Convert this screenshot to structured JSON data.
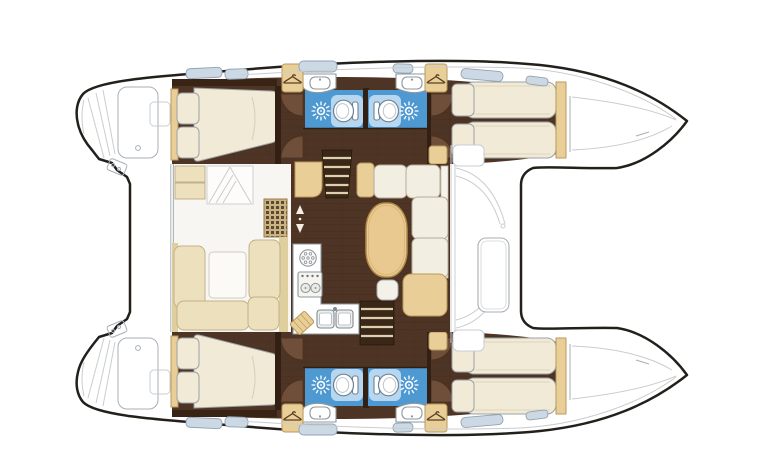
{
  "image": {
    "description": "Catamaran yacht interior layout floor plan, top-down view, bows pointing right",
    "visible_text": []
  },
  "vessel": {
    "type": "catamaran-floor-plan",
    "hulls": [
      {
        "name": "port-hull",
        "rooms": [
          "aft-double-cabin",
          "aft-head-with-shower",
          "forward-head-with-shower",
          "forward-double-cabin"
        ]
      },
      {
        "name": "starboard-hull",
        "rooms": [
          "aft-double-cabin",
          "aft-head-with-shower",
          "forward-head-with-shower",
          "forward-double-cabin"
        ]
      }
    ],
    "saloon": [
      "u-shaped-settee",
      "storage-lockers",
      "chart-grid-mat",
      "companionway-arrows",
      "galley-round-burner",
      "two-burner-stove",
      "double-sink",
      "cutting-board",
      "port-companionway-stairs",
      "starboard-companionway-stairs",
      "l-shaped-sofa",
      "oval-dining-table",
      "stool"
    ],
    "cockpit": [
      "transom-steps",
      "bench-port",
      "bench-starboard"
    ],
    "foredeck": [
      "deck-hatch",
      "step-seats"
    ],
    "fixture_counts": {
      "shower-sunburst": 4,
      "toilet": 4,
      "washbasin": 4,
      "wardrobe-hanger": 4,
      "deck-window": 12,
      "double-berth": 2,
      "twin-berth-pairs": 2
    }
  },
  "icons": {
    "sunburst-icon": "shower jet / drain",
    "toilet-icon": "marine WC",
    "hanger-icon": "hanging wardrobe",
    "basin-icon": "washbasin",
    "stove-icon": "two-burner hob",
    "sink-icon": "double galley sink",
    "arrow-icon": "up/down companionway marker"
  },
  "palette": {
    "hull-outline": "#23201c",
    "gray-line": "#a9afb5",
    "soft-line": "#c9cdd0",
    "walnut": "#4e3424",
    "walnut-deep": "#382315",
    "wall": "#332014",
    "door": "#6f4e3a",
    "door-edge": "#49321f",
    "floor-white": "#f7f6f2",
    "beige": "#ece0bd",
    "beige-edge": "#c3b189",
    "beige-deep": "#e0cf9e",
    "tan": "#e9cf97",
    "tan-edge": "#b9995c",
    "cream": "#f1ead7",
    "cream-edge": "#9ba2a6",
    "bath-blue": "#4f99d3",
    "bath-blue-light": "#b7d7f1",
    "window": "#ccd9e5",
    "window-edge": "#8fa3b3",
    "table-wood": "#e9c98f",
    "table-edge": "#b08b4a",
    "tread": "#dcd0ae",
    "stair": "#3a2718",
    "mat": "#c9b383",
    "mat-dot": "#5d4832",
    "fixture-edge": "#8b979e",
    "cushion-white": "#f2eee2",
    "cushion-edge": "#b5ac98",
    "arrow": "#f4efe2",
    "hanger": "#5a4024"
  }
}
